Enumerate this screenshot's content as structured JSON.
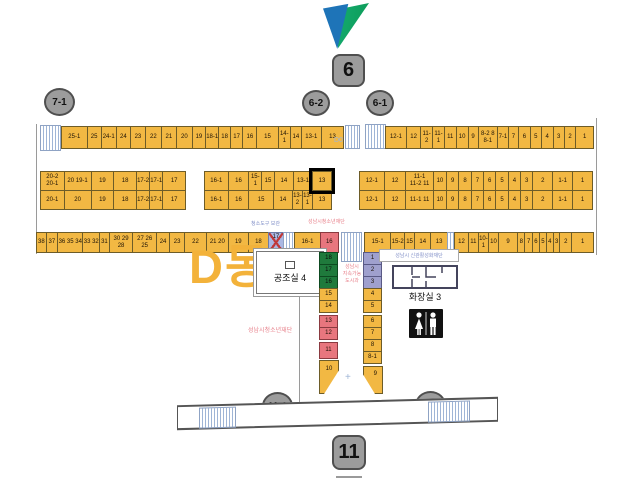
{
  "building": {
    "label": "D동"
  },
  "markers": {
    "m7_1": "7-1",
    "m6": "6",
    "m6_2": "6-2",
    "m6_1": "6-1",
    "m11_1": "11-1",
    "m11_2": "11-2",
    "m11": "11"
  },
  "row1": {
    "d0_label": "D0",
    "left": [
      {
        "t": "25-1",
        "w": 28
      },
      {
        "t": "25",
        "w": 15
      },
      {
        "t": "24-1",
        "w": 16
      },
      {
        "t": "24",
        "w": 15
      },
      {
        "t": "23",
        "w": 16
      },
      {
        "t": "22",
        "w": 17
      },
      {
        "t": "21",
        "w": 16
      },
      {
        "t": "20",
        "w": 17
      },
      {
        "t": "19",
        "w": 14
      },
      {
        "t": "18-1",
        "w": 14
      },
      {
        "t": "18",
        "w": 12
      },
      {
        "t": "17",
        "w": 13
      },
      {
        "t": "16",
        "w": 15
      },
      {
        "t": "15",
        "w": 23
      },
      {
        "t": "14-1",
        "w": 13
      },
      {
        "t": "14",
        "w": 11
      },
      {
        "t": "13-1",
        "w": 22
      },
      {
        "t": "13",
        "w": 24
      }
    ],
    "right": [
      {
        "t": "12-1",
        "w": 24
      },
      {
        "t": "12",
        "w": 16
      },
      {
        "t": "11-2",
        "w": 13
      },
      {
        "t": "11-1",
        "w": 13
      },
      {
        "t": "11",
        "w": 13
      },
      {
        "t": "10",
        "w": 13
      },
      {
        "t": "9",
        "w": 11
      },
      {
        "t": "8-2  8\n8-1",
        "w": 22
      },
      {
        "t": "7-1",
        "w": 12
      },
      {
        "t": "7",
        "w": 11
      },
      {
        "t": "6",
        "w": 13
      },
      {
        "t": "5",
        "w": 12
      },
      {
        "t": "4",
        "w": 13
      },
      {
        "t": "3",
        "w": 12
      },
      {
        "t": "2",
        "w": 13
      },
      {
        "t": "1",
        "w": 20
      }
    ]
  },
  "row2": {
    "left_top": [
      {
        "t": "20-2\n20-1",
        "w": 26
      },
      {
        "t": "20  19-1",
        "w": 30
      },
      {
        "t": "19",
        "w": 25
      },
      {
        "t": "18",
        "w": 25
      },
      {
        "t": "17-2",
        "w": 14
      },
      {
        "t": "17-1",
        "w": 14
      },
      {
        "t": "17",
        "w": 25
      }
    ],
    "left_bottom": [
      {
        "t": "20-1",
        "w": 26
      },
      {
        "t": "20",
        "w": 30
      },
      {
        "t": "19",
        "w": 25
      },
      {
        "t": "18",
        "w": 25
      },
      {
        "t": "17-2",
        "w": 14
      },
      {
        "t": "17-1",
        "w": 14
      },
      {
        "t": "17",
        "w": 25
      }
    ],
    "mid_top": [
      {
        "t": "16-1",
        "w": 25
      },
      {
        "t": "16",
        "w": 22
      },
      {
        "t": "15-1",
        "w": 13
      },
      {
        "t": "15",
        "w": 13
      },
      {
        "t": "14",
        "w": 20
      },
      {
        "t": "13-1",
        "w": 20
      },
      {
        "t": "13",
        "w": 20,
        "hl": true
      }
    ],
    "mid_bottom": [
      {
        "t": "16-1",
        "w": 25
      },
      {
        "t": "16",
        "w": 22
      },
      {
        "t": "15",
        "w": 26
      },
      {
        "t": "14",
        "w": 20
      },
      {
        "t": "13-2",
        "w": 10
      },
      {
        "t": "13-1",
        "w": 10
      },
      {
        "t": "13",
        "w": 20
      }
    ],
    "right_top": [
      {
        "t": "12-1",
        "w": 25
      },
      {
        "t": "12",
        "w": 22
      },
      {
        "t": "11-1\n11-2  11",
        "w": 28
      },
      {
        "t": "10",
        "w": 13
      },
      {
        "t": "9",
        "w": 12
      },
      {
        "t": "8",
        "w": 12
      },
      {
        "t": "7",
        "w": 12
      },
      {
        "t": "6",
        "w": 12
      },
      {
        "t": "5",
        "w": 12
      },
      {
        "t": "4",
        "w": 12
      },
      {
        "t": "3",
        "w": 12
      },
      {
        "t": "2",
        "w": 20
      },
      {
        "t": "1-1",
        "w": 20
      },
      {
        "t": "1",
        "w": 20
      }
    ],
    "right_bottom": [
      {
        "t": "12-1",
        "w": 25
      },
      {
        "t": "12",
        "w": 22
      },
      {
        "t": "11-1  11",
        "w": 28
      },
      {
        "t": "10",
        "w": 13
      },
      {
        "t": "9",
        "w": 12
      },
      {
        "t": "8",
        "w": 12
      },
      {
        "t": "7",
        "w": 12
      },
      {
        "t": "6",
        "w": 12
      },
      {
        "t": "5",
        "w": 12
      },
      {
        "t": "4",
        "w": 12
      },
      {
        "t": "3",
        "w": 12
      },
      {
        "t": "2",
        "w": 20
      },
      {
        "t": "1-1",
        "w": 20
      },
      {
        "t": "1",
        "w": 20
      }
    ]
  },
  "row3": {
    "left": [
      {
        "t": "38",
        "w": 10
      },
      {
        "t": "37",
        "w": 12
      },
      {
        "t": "36 35 34",
        "w": 28
      },
      {
        "t": "33 32",
        "w": 18
      },
      {
        "t": "31",
        "w": 10
      },
      {
        "t": "30 29 28",
        "w": 26
      },
      {
        "t": "27 26 25",
        "w": 26
      },
      {
        "t": "24",
        "w": 14
      },
      {
        "t": "23",
        "w": 16
      },
      {
        "t": "22",
        "w": 24
      },
      {
        "t": "21  20",
        "w": 24
      },
      {
        "t": "19",
        "w": 22
      },
      {
        "t": "18",
        "w": 22
      },
      {
        "t": "17",
        "w": 16,
        "c": "x"
      },
      {
        "w": 12,
        "c": "s"
      },
      {
        "t": "16-1",
        "w": 28
      },
      {
        "t": "16",
        "w": 20,
        "c": "r"
      }
    ],
    "right": [
      {
        "t": "15-1",
        "w": 28
      },
      {
        "t": "15-2",
        "w": 14
      },
      {
        "t": "15",
        "w": 10
      },
      {
        "t": "14",
        "w": 17
      },
      {
        "t": "13",
        "w": 17
      },
      {
        "w": 7,
        "c": "s"
      },
      {
        "t": "12",
        "w": 14
      },
      {
        "t": "11",
        "w": 10
      },
      {
        "t": "10-1",
        "w": 10
      },
      {
        "t": "10",
        "w": 10
      },
      {
        "t": "9",
        "w": 20
      },
      {
        "t": "8",
        "w": 7
      },
      {
        "t": "7",
        "w": 7
      },
      {
        "t": "6",
        "w": 7
      },
      {
        "t": "5",
        "w": 6
      },
      {
        "t": "4",
        "w": 7
      },
      {
        "t": "3",
        "w": 6
      },
      {
        "t": "2",
        "w": 12
      },
      {
        "t": "1",
        "w": 23
      }
    ]
  },
  "wing": {
    "left_col": [
      {
        "t": "18",
        "c": "g"
      },
      {
        "t": "17",
        "c": "g"
      },
      {
        "t": "16",
        "c": "g"
      },
      {
        "t": "15"
      },
      {
        "t": "14"
      },
      {
        "t": "13",
        "c": "r",
        "mt": 2
      },
      {
        "t": "12",
        "c": "r"
      },
      {
        "t": "11",
        "c": "r",
        "mt": 2,
        "h": 17
      }
    ],
    "right_col": [
      {
        "t": "1",
        "c": "p"
      },
      {
        "t": "2",
        "c": "p"
      },
      {
        "t": "3",
        "c": "p"
      },
      {
        "t": "4"
      },
      {
        "t": "5"
      },
      {
        "t": "6",
        "mt": 2
      },
      {
        "t": "7"
      },
      {
        "t": "8"
      },
      {
        "t": "8-1"
      }
    ],
    "funnel_left": "10",
    "funnel_right": "9"
  },
  "rooms": {
    "hvac": "공조실 4",
    "toilet": "화장실 3"
  },
  "notes": {
    "aisle_org": "성남시\n지속가능\n도시과",
    "left_org": "성남시청소년재단",
    "top_org": "성남시청소년재단",
    "cleaning": "청소도구 보관",
    "toilet_org": "성남시 신관활성화재단"
  },
  "colors": {
    "stall_yellow": "#F2B843",
    "occupied_red": "#E8767E",
    "occupied_green": "#1F7A3C",
    "occupied_purple": "#9FA0CE",
    "stair_blue": "#9FB5D6",
    "blocked_blue": "#AAB8E4",
    "marker_gray": "#9C9C9C",
    "pink_text": "#E8828C",
    "blue_text": "#8290C8",
    "dong_orange": "#F3B23A",
    "logo_blue": "#1E74B8",
    "logo_green": "#12A968"
  }
}
